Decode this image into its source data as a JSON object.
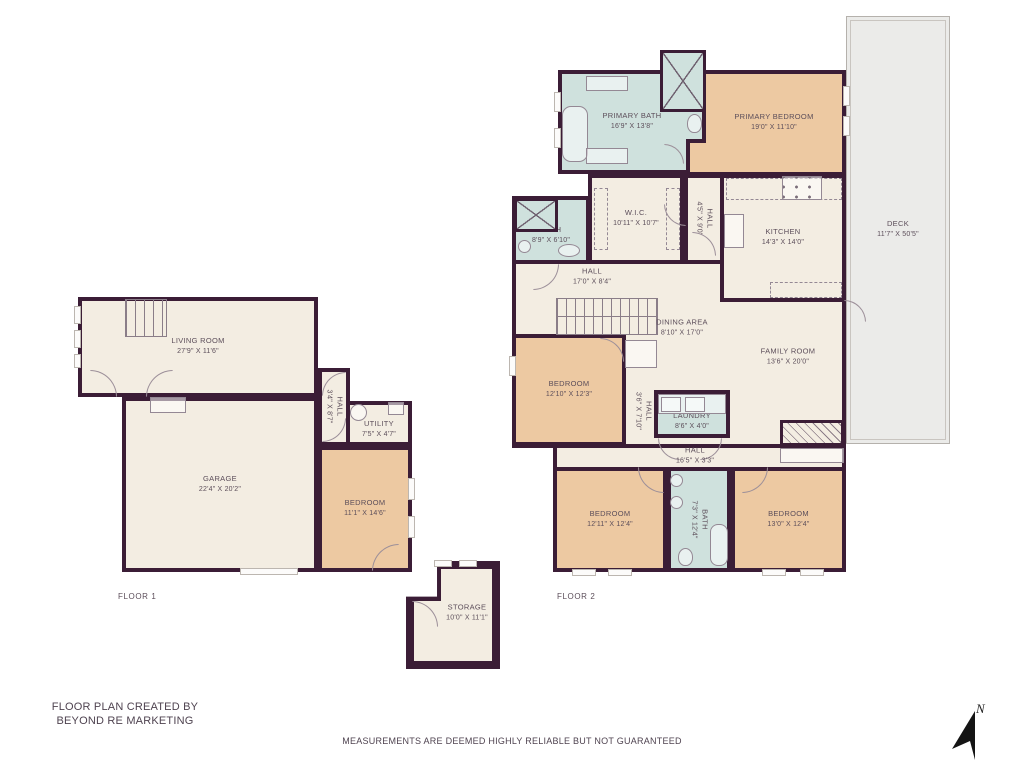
{
  "title_block": {
    "credit_line1": "FLOOR PLAN CREATED BY",
    "credit_line2": "BEYOND RE MARKETING",
    "disclaimer": "MEASUREMENTS ARE DEEMED HIGHLY RELIABLE BUT NOT GUARANTEED",
    "north_label": "N"
  },
  "floors": {
    "floor1_label": "FLOOR 1",
    "floor2_label": "FLOOR 2"
  },
  "colors": {
    "wall": "#3b1d36",
    "room_cream": "#f3ede2",
    "room_orange": "#edc9a2",
    "room_blue": "#cfe1dd",
    "deck_gray": "#ebebe9",
    "label_text": "#5c4e5a"
  },
  "rooms": [
    {
      "id": "living-room",
      "name": "LIVING ROOM",
      "dims": "27'9\" X 11'6\""
    },
    {
      "id": "garage",
      "name": "GARAGE",
      "dims": "22'4\" X 20'2\""
    },
    {
      "id": "hall-floor1",
      "name": "HALL",
      "dims": "3'4\" X 8'7\""
    },
    {
      "id": "utility",
      "name": "UTILITY",
      "dims": "7'5\" X 4'7\""
    },
    {
      "id": "bedroom-floor1",
      "name": "BEDROOM",
      "dims": "11'1\" X 14'6\""
    },
    {
      "id": "storage",
      "name": "STORAGE",
      "dims": "10'0\" X 11'1\""
    },
    {
      "id": "primary-bath",
      "name": "PRIMARY BATH",
      "dims": "16'9\" X 13'8\""
    },
    {
      "id": "primary-bedroom",
      "name": "PRIMARY BEDROOM",
      "dims": "19'0\" X 11'10\""
    },
    {
      "id": "wic",
      "name": "W.I.C.",
      "dims": "10'11\" X 10'7\""
    },
    {
      "id": "hall-upper",
      "name": "HALL",
      "dims": "4'5\" X 9'0\""
    },
    {
      "id": "kitchen",
      "name": "KITCHEN",
      "dims": "14'3\" X 14'0\""
    },
    {
      "id": "bath-small",
      "name": "BATH",
      "dims": "8'9\" X 6'10\""
    },
    {
      "id": "hall-main",
      "name": "HALL",
      "dims": "17'0\" X 8'4\""
    },
    {
      "id": "dining-area",
      "name": "DINING AREA",
      "dims": "8'10\" X 17'0\""
    },
    {
      "id": "family-room",
      "name": "FAMILY ROOM",
      "dims": "13'6\" X 20'0\""
    },
    {
      "id": "bedroom-mid",
      "name": "BEDROOM",
      "dims": "12'10\" X 12'3\""
    },
    {
      "id": "hall-small",
      "name": "HALL",
      "dims": "3'6\" X 7'10\""
    },
    {
      "id": "laundry",
      "name": "LAUNDRY",
      "dims": "8'6\" X 4'0\""
    },
    {
      "id": "hall-lower",
      "name": "HALL",
      "dims": "16'5\" X 3'3\""
    },
    {
      "id": "bedroom-left",
      "name": "BEDROOM",
      "dims": "12'11\" X 12'4\""
    },
    {
      "id": "bath-mid",
      "name": "BATH",
      "dims": "7'3\" X 12'4\""
    },
    {
      "id": "bedroom-right",
      "name": "BEDROOM",
      "dims": "13'0\" X 12'4\""
    },
    {
      "id": "deck",
      "name": "DECK",
      "dims": "11'7\" X 50'5\""
    }
  ]
}
